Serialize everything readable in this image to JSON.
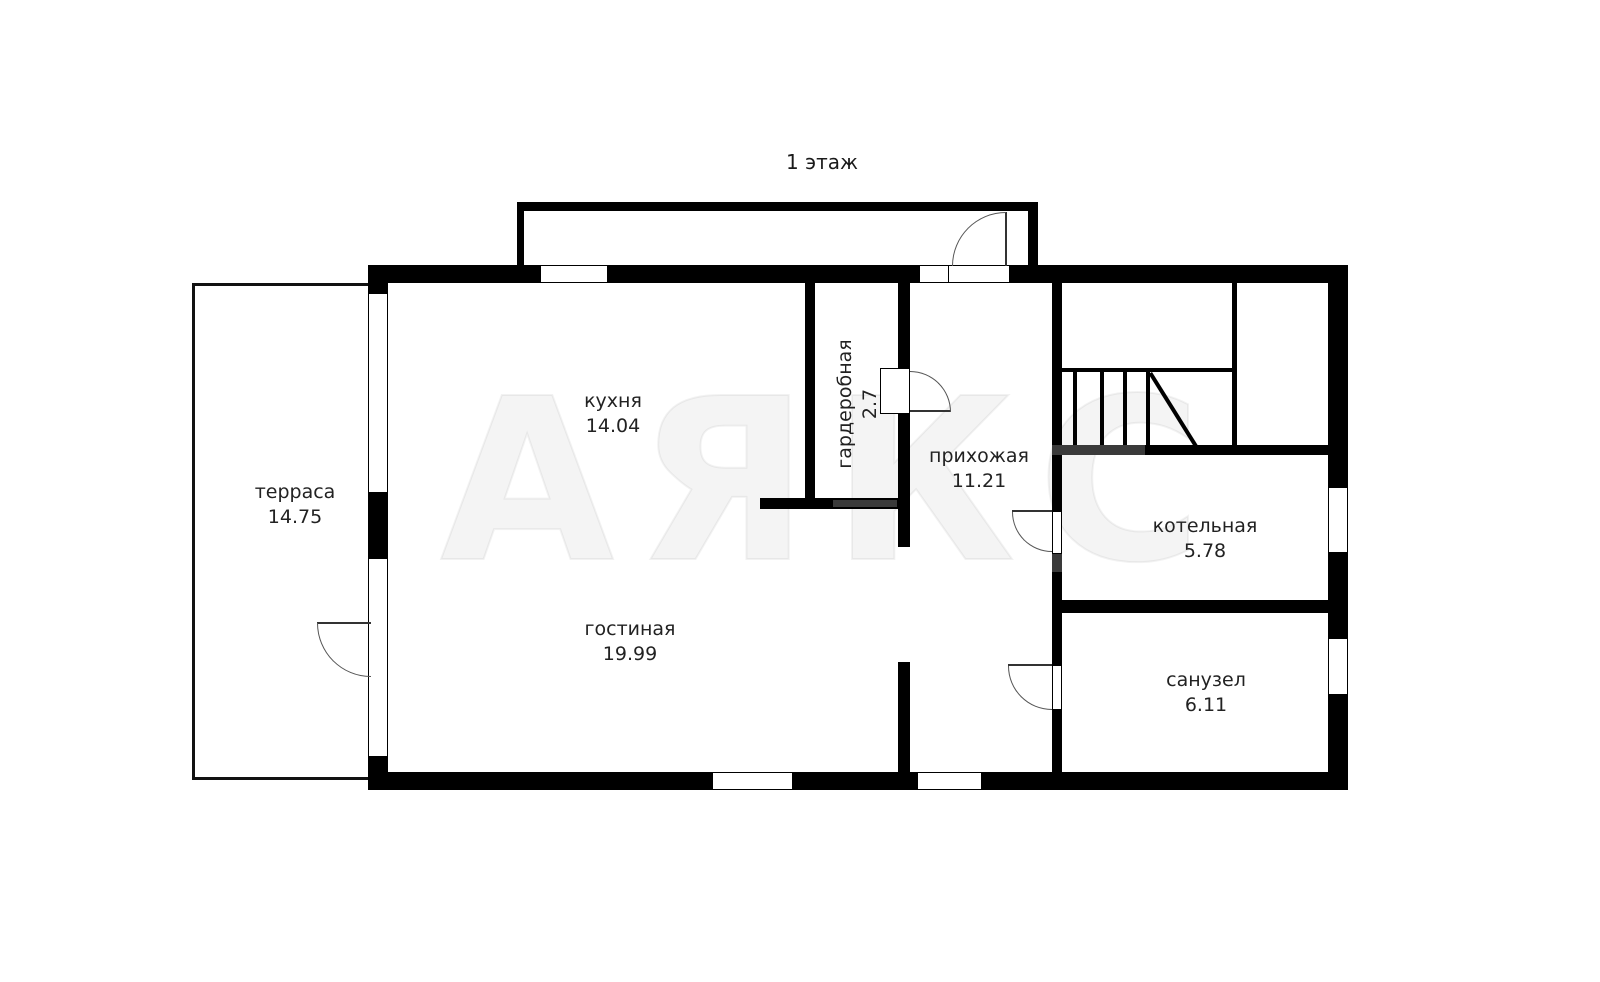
{
  "title": "1 этаж",
  "watermark": "АЯКС",
  "rooms": {
    "terrace": {
      "name": "терраса",
      "area": "14.75"
    },
    "kitchen": {
      "name": "кухня",
      "area": "14.04"
    },
    "wardrobe": {
      "name": "гардеробная",
      "area": "2.7"
    },
    "hallway": {
      "name": "прихожая",
      "area": "11.21"
    },
    "boiler": {
      "name": "котельная",
      "area": "5.78"
    },
    "bathroom": {
      "name": "санузел",
      "area": "6.11"
    },
    "living": {
      "name": "гостиная",
      "area": "19.99"
    }
  },
  "colors": {
    "wall": "#000000",
    "wall_secondary": "#3a3a3a",
    "label_text": "#222222"
  }
}
